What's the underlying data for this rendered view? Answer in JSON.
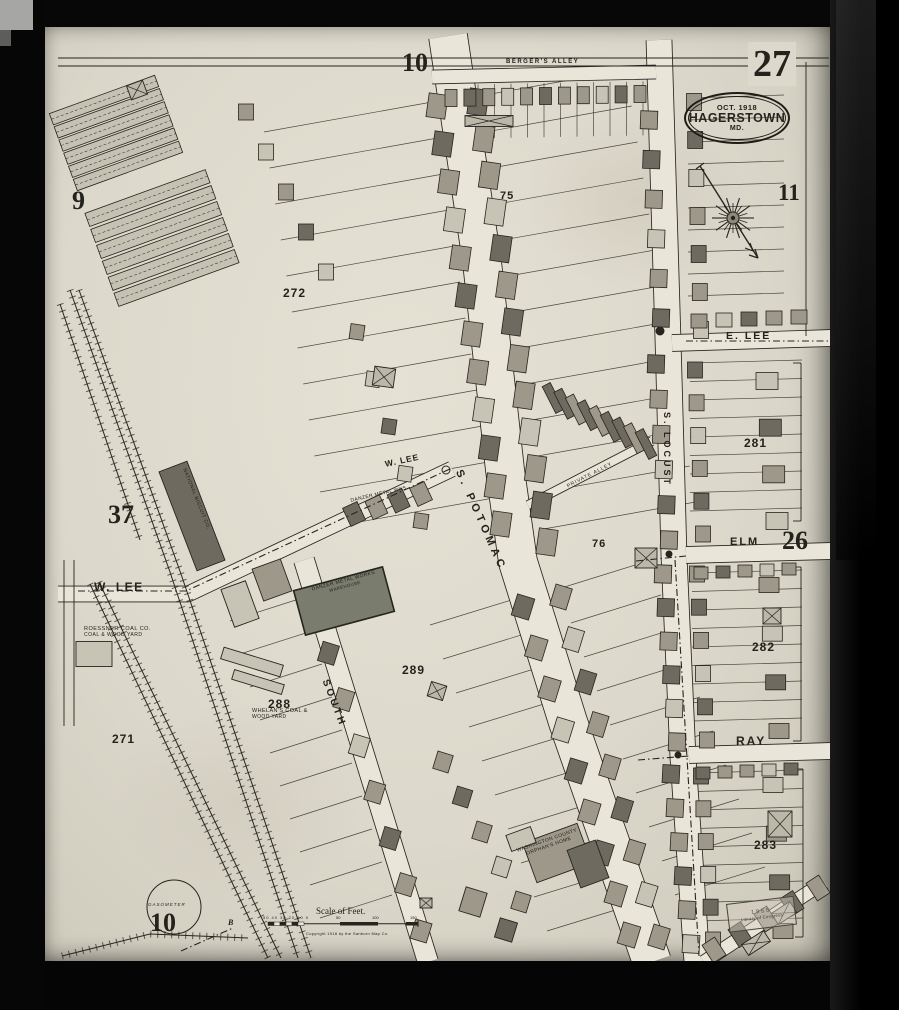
{
  "sheet": {
    "number": "27",
    "city_stamp": {
      "date": "OCT. 1918",
      "city": "HAGERSTOWN",
      "state": "MD."
    },
    "adjacent_sheets": {
      "nw": "9",
      "north": "10",
      "east": "11",
      "west": "37",
      "southeast": "26",
      "south": "10"
    },
    "loc_stamp": {
      "line1": "1955",
      "line2": "Library of Congress"
    }
  },
  "streets": {
    "bergers_alley": "BERGER'S  ALLEY",
    "e_lee": "E. LEE",
    "w_lee_left": "W. LEE",
    "w_lee_diag": "W. LEE",
    "s_potomac": "S. POTOMAC",
    "s_locust": "S. LOCUST",
    "elm": "ELM",
    "ray": "RAY",
    "south": "SOUTH",
    "private_alley": "PRIVATE  ALLEY"
  },
  "blocks": {
    "b271": "271",
    "b272": "272",
    "b281": "281",
    "b282": "282",
    "b283": "283",
    "b288": "288",
    "b289": "289",
    "b75": "75",
    "b76": "76"
  },
  "places": {
    "national_biscuit": "NATIONAL BISCUIT CO.",
    "danzer_label": "DANZER METAL WKS.",
    "danzer_warehouse_1": "DANZER METAL WORKS",
    "danzer_warehouse_2": "WAREHOUSE",
    "roessner_1": "ROESSNER COAL CO.",
    "roessner_2": "COAL & WOOD YARD",
    "whelan_1": "WHELAN'S COAL &",
    "whelan_2": "WOOD YARD",
    "orphans_1": "WASHINGTON COUNTY",
    "orphans_2": "ORPHAN'S HOME",
    "gasometer": "GASOMETER",
    "point_b": "B"
  },
  "scale_bar": {
    "title": "Scale of Feet.",
    "left_ticks": "50 40 30 20 10 0",
    "mid": "50",
    "right": "100",
    "far": "150",
    "copyright": "Copyright 1918 by the Sanborn Map Co."
  },
  "map_geometry": {
    "ink": "#26251f",
    "street_fill": "#e9e5d8",
    "shades": {
      "a": "#c8c4b5",
      "b": "#9d988a",
      "c": "#6e6a60",
      "d": "#d9d5c6",
      "g": "#7a7d6d"
    },
    "streets": [
      {
        "name": "s-potomac",
        "w": 38,
        "pts": [
          [
            448,
            36
          ],
          [
            482,
            262
          ],
          [
            505,
            470
          ],
          [
            518,
            562
          ],
          [
            568,
            722
          ],
          [
            652,
            962
          ]
        ]
      },
      {
        "name": "s-locust",
        "w": 25,
        "pts": [
          [
            659,
            40
          ],
          [
            668,
            340
          ],
          [
            674,
            556
          ],
          [
            683,
            758
          ],
          [
            697,
            962
          ]
        ]
      },
      {
        "name": "bergers-alley",
        "w": 13,
        "pts": [
          [
            432,
            77
          ],
          [
            656,
            72
          ]
        ]
      },
      {
        "name": "e-lee",
        "w": 16,
        "pts": [
          [
            672,
            343
          ],
          [
            831,
            338
          ]
        ]
      },
      {
        "name": "elm",
        "w": 16,
        "pts": [
          [
            686,
            555
          ],
          [
            831,
            551
          ]
        ]
      },
      {
        "name": "ray",
        "w": 16,
        "pts": [
          [
            689,
            755
          ],
          [
            831,
            751
          ]
        ]
      },
      {
        "name": "w-lee",
        "w": 15,
        "pts": [
          [
            58,
            594
          ],
          [
            188,
            594
          ],
          [
            452,
            469
          ]
        ]
      },
      {
        "name": "south",
        "w": 20,
        "pts": [
          [
            304,
            560
          ],
          [
            428,
            962
          ]
        ]
      },
      {
        "name": "private-alley",
        "w": 8,
        "pts": [
          [
            528,
            505
          ],
          [
            652,
            441
          ]
        ]
      },
      {
        "name": "se-diagonal",
        "w": 13,
        "pts": [
          [
            704,
            962
          ],
          [
            824,
            882
          ]
        ]
      }
    ],
    "lotlines": [
      {
        "x": 432,
        "y": 102,
        "sx": 5.6,
        "sy": 36,
        "n": 12,
        "ex": -168,
        "ey": 30
      },
      {
        "x": 474,
        "y": 97,
        "sx": 5.8,
        "sy": 36,
        "n": 13,
        "ex": 152,
        "ey": -27
      },
      {
        "x": 518,
        "y": 598,
        "sx": 13,
        "sy": 34,
        "n": 10,
        "ex": -88,
        "ey": 27
      },
      {
        "x": 558,
        "y": 589,
        "sx": 13,
        "sy": 34,
        "n": 10,
        "ex": 90,
        "ey": -28
      },
      {
        "x": 302,
        "y": 598,
        "sx": 10,
        "sy": 33,
        "n": 10,
        "ex": -72,
        "ey": 23
      },
      {
        "x": 690,
        "y": 363,
        "sx": 0,
        "sy": 18.5,
        "n": 9,
        "ex": 112,
        "ey": -3
      },
      {
        "x": 692,
        "y": 573,
        "sx": 0,
        "sy": 18.5,
        "n": 9,
        "ex": 110,
        "ey": -3
      },
      {
        "x": 695,
        "y": 773,
        "sx": 0,
        "sy": 18.5,
        "n": 9,
        "ex": 108,
        "ey": -3
      },
      {
        "x": 688,
        "y": 98,
        "sx": 0,
        "sy": 22,
        "n": 10,
        "ex": 96,
        "ey": -3
      },
      {
        "x": 445,
        "y": 85,
        "sx": 16.5,
        "sy": -0.3,
        "n": 13,
        "ex": 0,
        "ey": 54
      }
    ],
    "rows": [
      [
        437,
        106,
        501,
        524,
        12,
        19,
        24,
        8,
        "bcbabcbbacbb"
      ],
      [
        478,
        102,
        547,
        542,
        13,
        19,
        26,
        8,
        "cbbacbcbbabcb"
      ],
      [
        553,
        398,
        646,
        444,
        9,
        9,
        30,
        -27,
        "ccbcbccbc"
      ],
      [
        649,
        120,
        661,
        318,
        6,
        17,
        18,
        2,
        "bcbabc"
      ],
      [
        656,
        364,
        669,
        540,
        6,
        17,
        18,
        2,
        "cbbacb"
      ],
      [
        663,
        574,
        677,
        742,
        6,
        17,
        18,
        2,
        "bcbcab"
      ],
      [
        671,
        774,
        691,
        944,
        6,
        17,
        18,
        3,
        "cbbcba"
      ],
      [
        694,
        102,
        701,
        330,
        7,
        15,
        17,
        0,
        "bcabcba"
      ],
      [
        695,
        370,
        703,
        534,
        6,
        15,
        16,
        0,
        "cbabcb"
      ],
      [
        697,
        574,
        707,
        740,
        6,
        15,
        16,
        0,
        "bcbacb"
      ],
      [
        701,
        776,
        713,
        940,
        6,
        15,
        16,
        0,
        "cbbacb"
      ],
      [
        451,
        98,
        640,
        94,
        11,
        12,
        17,
        0,
        "bcbabcbbacb"
      ],
      [
        699,
        321,
        799,
        317,
        5,
        16,
        14,
        0,
        "bacbb"
      ],
      [
        701,
        573,
        789,
        569,
        5,
        14,
        12,
        0,
        "bcbab"
      ],
      [
        703,
        773,
        791,
        769,
        5,
        14,
        12,
        0,
        "cbbac"
      ],
      [
        313,
        607,
        421,
        931,
        8,
        17,
        20,
        17,
        "bcbabcbb"
      ],
      [
        523,
        607,
        629,
        935,
        9,
        18,
        22,
        17,
        "cbbacbcbb"
      ],
      [
        561,
        597,
        659,
        937,
        9,
        17,
        22,
        17,
        "bacbbcbab"
      ],
      [
        767,
        381,
        777,
        521,
        4,
        22,
        17,
        0,
        "acba"
      ],
      [
        769,
        585,
        779,
        731,
        4,
        20,
        15,
        0,
        "bacb"
      ],
      [
        773,
        785,
        783,
        931,
        4,
        20,
        15,
        0,
        "abcb"
      ],
      [
        714,
        950,
        818,
        888,
        5,
        15,
        21,
        -33,
        "bcbcb"
      ],
      [
        246,
        112,
        326,
        272,
        5,
        15,
        16,
        0,
        "babca"
      ],
      [
        357,
        332,
        421,
        521,
        5,
        14,
        15,
        8,
        "bacab"
      ],
      [
        354,
        514,
        421,
        494,
        4,
        16,
        20,
        -25,
        "cbcb"
      ],
      [
        443,
        762,
        521,
        902,
        5,
        16,
        18,
        17,
        "bcbab"
      ]
    ],
    "sheds": [
      {
        "cx": 116,
        "cy": 133,
        "n": 6,
        "w": 112,
        "h": 12,
        "gap": 14,
        "rot": -20
      },
      {
        "cx": 162,
        "cy": 238,
        "n": 6,
        "w": 128,
        "h": 14,
        "gap": 17,
        "rot": -20
      }
    ],
    "buildings": [
      [
        192,
        516,
        30,
        106,
        -21,
        "c"
      ],
      [
        344,
        601,
        92,
        46,
        -15,
        "g"
      ],
      [
        557,
        853,
        58,
        42,
        -20,
        "b"
      ],
      [
        588,
        864,
        30,
        40,
        -20,
        "c"
      ],
      [
        521,
        839,
        26,
        17,
        -20,
        "a"
      ],
      [
        94,
        654,
        36,
        25,
        0,
        "a"
      ],
      [
        252,
        662,
        62,
        12,
        17,
        "a"
      ],
      [
        258,
        682,
        52,
        10,
        17,
        "a"
      ],
      [
        473,
        902,
        22,
        25,
        17,
        "b"
      ],
      [
        506,
        930,
        18,
        20,
        17,
        "c"
      ],
      [
        272,
        580,
        30,
        34,
        -20,
        "b"
      ],
      [
        240,
        604,
        26,
        40,
        -20,
        "a"
      ]
    ],
    "xboxes": [
      [
        137,
        90,
        17,
        15,
        -20
      ],
      [
        489,
        121,
        48,
        11,
        0
      ],
      [
        384,
        377,
        21,
        19,
        8
      ],
      [
        646,
        558,
        22,
        20,
        0
      ],
      [
        772,
        616,
        18,
        16,
        0
      ],
      [
        780,
        824,
        24,
        26,
        0
      ],
      [
        437,
        691,
        16,
        15,
        17
      ],
      [
        756,
        943,
        26,
        13,
        -33
      ],
      [
        784,
        913,
        22,
        13,
        -33
      ],
      [
        426,
        903,
        12,
        10,
        0
      ]
    ],
    "railroads": [
      [
        [
          70,
          290
        ],
        [
          170,
          572
        ],
        [
          298,
          958
        ]
      ],
      [
        [
          79,
          290
        ],
        [
          181,
          574
        ],
        [
          311,
          958
        ]
      ],
      [
        [
          60,
          304
        ],
        [
          140,
          540
        ]
      ],
      [
        [
          90,
          584
        ],
        [
          268,
          958
        ]
      ],
      [
        [
          99,
          582
        ],
        [
          281,
          958
        ]
      ],
      [
        [
          62,
          956
        ],
        [
          150,
          934
        ],
        [
          248,
          938
        ]
      ]
    ],
    "dashlines": [
      [
        [
          78,
          591
        ],
        [
          186,
          591
        ],
        [
          452,
          468
        ]
      ],
      [
        [
          686,
          341
        ],
        [
          830,
          341
        ]
      ],
      [
        [
          636,
          561
        ],
        [
          686,
          556
        ]
      ],
      [
        [
          638,
          760
        ],
        [
          689,
          756
        ]
      ],
      [
        [
          675,
          560
        ],
        [
          687,
          758
        ],
        [
          699,
          956
        ]
      ],
      [
        [
          181,
          951
        ],
        [
          233,
          928
        ]
      ]
    ],
    "lines": [
      [
        58,
        58,
        829,
        58
      ],
      [
        58,
        66,
        829,
        66
      ],
      [
        806,
        62,
        806,
        336
      ],
      [
        64,
        560,
        64,
        726
      ],
      [
        74,
        560,
        74,
        726
      ]
    ],
    "brackets": [
      [
        801,
        363,
        521
      ],
      [
        801,
        567,
        741
      ],
      [
        803,
        769,
        937
      ]
    ],
    "circles": [
      {
        "cx": 660,
        "cy": 331,
        "r": 4,
        "f": 1
      },
      {
        "cx": 669,
        "cy": 554,
        "r": 3,
        "f": 1
      },
      {
        "cx": 678,
        "cy": 755,
        "r": 3,
        "f": 1
      },
      {
        "cx": 446,
        "cy": 470,
        "r": 4,
        "f": 0
      },
      {
        "cx": 174,
        "cy": 907,
        "r": 27,
        "f": 0
      }
    ],
    "compass": {
      "cx": 733,
      "cy": 218
    },
    "scalebar": {
      "x": 268,
      "y": 922,
      "w": 150
    }
  }
}
